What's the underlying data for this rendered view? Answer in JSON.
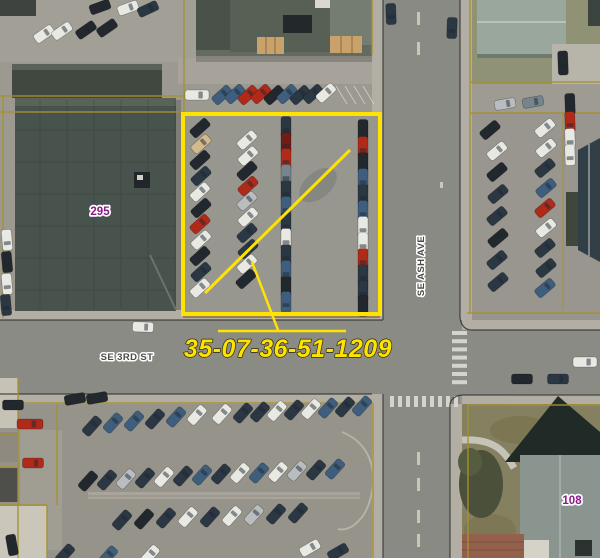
{
  "map": {
    "highlight_parcel_id": "35-07-36-51-1209",
    "labels": {
      "street_horizontal": "SE 3RD ST",
      "street_vertical": "SE ASH AVE",
      "parcel_left": "295",
      "parcel_right": "108"
    },
    "colors": {
      "highlight": "#ffe300",
      "parcel_line": "#a5912f",
      "parcel_number": "#8b1a89",
      "street_label": "#4a4a46",
      "curb_line": "#2b2b28"
    }
  }
}
